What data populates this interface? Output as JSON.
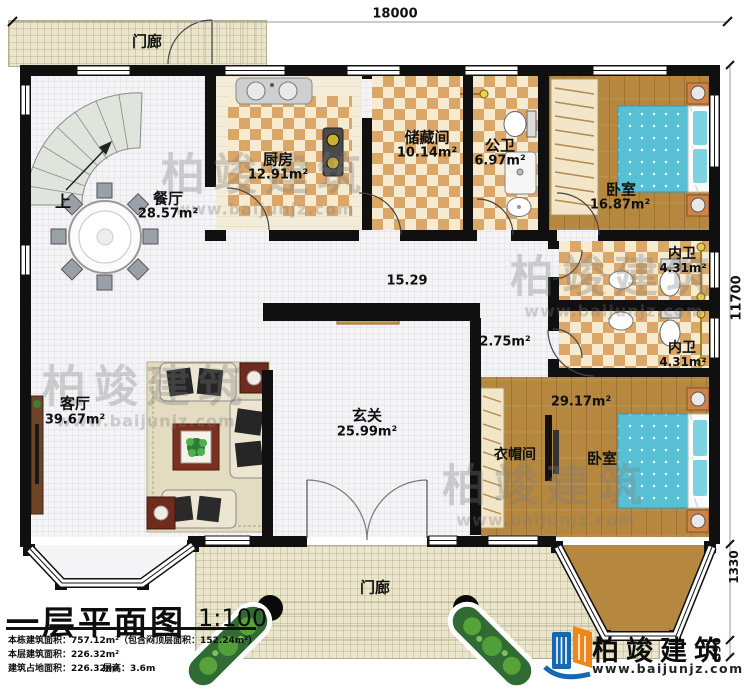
{
  "dimensions": {
    "top": "18000",
    "right_main": "11700",
    "right_bay": "1330",
    "right_step": "590"
  },
  "labels": {
    "porch_top": "门廊",
    "porch_bottom": "门廊",
    "up": "上",
    "dining": {
      "name": "餐厅",
      "area": "28.57m²"
    },
    "kitchen": {
      "name": "厨房",
      "area": "12.91m²"
    },
    "storage": {
      "name": "储藏间",
      "area": "10.14m²"
    },
    "public_bath": {
      "name": "公卫",
      "area": "6.97m²"
    },
    "bedroom_top": {
      "name": "卧室",
      "area": "16.87m²"
    },
    "inner_bath_1": {
      "name": "内卫",
      "area": "4.31m²"
    },
    "inner_bath_2": {
      "name": "内卫",
      "area": "4.31m²"
    },
    "hall": {
      "area": "15.29"
    },
    "passage": {
      "area": "2.75m²"
    },
    "shrine": "神龛",
    "living": {
      "name": "客厅",
      "area": "39.67m²"
    },
    "foyer": {
      "name": "玄关",
      "area": "25.99m²"
    },
    "cloakroom": {
      "name": "衣帽间"
    },
    "bedroom_bottom": {
      "name": "卧室",
      "area": "29.17m²"
    }
  },
  "title_block": {
    "title": "一层平面图",
    "scale": "1:100",
    "line1": "本栋建筑面积：757.12m²（包含闷顶层面积：152.24m²）",
    "line2": "本层建筑面积：226.32m²",
    "line3": "建筑占地面积：226.32m²",
    "line3b": "层高：3.6m"
  },
  "branding": {
    "company": "柏竣建筑",
    "website": "www.baijunjz.com"
  },
  "watermark": {
    "text": "柏竣建筑",
    "site": "www.baijunjz.com"
  }
}
